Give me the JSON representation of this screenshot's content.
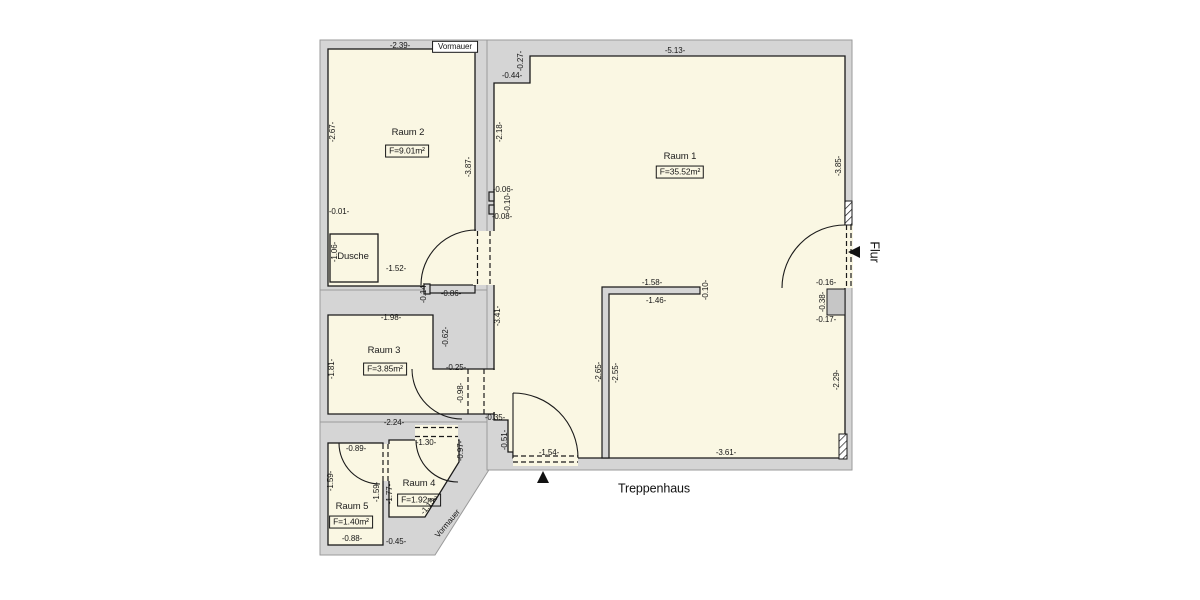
{
  "meta": {
    "drawing_type": "floor-plan",
    "language": "de"
  },
  "colors": {
    "room_fill": "#faf7e3",
    "wall_fill": "#d5d5d5",
    "outline": "#1a1a1a",
    "outer_edge": "#9a9a9a",
    "vormauer_block_fill": "#c6c6c6",
    "background": "#ffffff"
  },
  "plan": {
    "rooms_summary": [
      {
        "name": "Raum 1",
        "area": "F=35.52m²"
      },
      {
        "name": "Raum 2",
        "area": "F=9.01m²"
      },
      {
        "name": "Raum 3",
        "area": "F=3.85m²"
      },
      {
        "name": "Raum 4",
        "area": "F=1.92m²"
      },
      {
        "name": "Raum 5",
        "area": "F=1.40m²"
      },
      {
        "name": "Dusche",
        "area": ""
      }
    ],
    "zones": [
      "Treppenhaus",
      "Flur"
    ],
    "labels": [
      {
        "t": "-2.39-",
        "x": 400,
        "y": 46,
        "r": 0,
        "k": "d"
      },
      {
        "t": "Vormauer",
        "x": 455,
        "y": 47,
        "r": 0,
        "k": "db"
      },
      {
        "t": "-0.44-",
        "x": 512,
        "y": 76,
        "r": 0,
        "k": "d"
      },
      {
        "t": "-0.27-",
        "x": 521,
        "y": 61,
        "r": -90,
        "k": "d"
      },
      {
        "t": "-5.13-",
        "x": 675,
        "y": 51,
        "r": 0,
        "k": "d"
      },
      {
        "t": "-2.67-",
        "x": 333,
        "y": 132,
        "r": -90,
        "k": "d"
      },
      {
        "t": "Raum 2",
        "x": 408,
        "y": 133,
        "r": 0,
        "k": "room"
      },
      {
        "t": "F=9.01m²",
        "x": 407,
        "y": 151,
        "r": 0,
        "k": "area"
      },
      {
        "t": "-2.18-",
        "x": 500,
        "y": 132,
        "r": -90,
        "k": "d"
      },
      {
        "t": "-3.87-",
        "x": 469,
        "y": 167,
        "r": -90,
        "k": "d"
      },
      {
        "t": "Raum 1",
        "x": 680,
        "y": 157,
        "r": 0,
        "k": "room"
      },
      {
        "t": "F=35.52m²",
        "x": 680,
        "y": 172,
        "r": 0,
        "k": "area"
      },
      {
        "t": "-3.85-",
        "x": 839,
        "y": 166,
        "r": -90,
        "k": "d"
      },
      {
        "t": "-0.01-",
        "x": 339,
        "y": 212,
        "r": 0,
        "k": "d"
      },
      {
        "t": "-0.06-",
        "x": 503,
        "y": 190,
        "r": 0,
        "k": "d"
      },
      {
        "t": "-0.10-",
        "x": 508,
        "y": 203,
        "r": -90,
        "k": "d"
      },
      {
        "t": "-0.08-",
        "x": 502,
        "y": 217,
        "r": 0,
        "k": "d"
      },
      {
        "t": "-1.06-",
        "x": 335,
        "y": 252,
        "r": -90,
        "k": "d"
      },
      {
        "t": "Dusche",
        "x": 353,
        "y": 257,
        "r": 0,
        "k": "room"
      },
      {
        "t": "-1.52-",
        "x": 396,
        "y": 269,
        "r": 0,
        "k": "d"
      },
      {
        "t": "-0.86-",
        "x": 451,
        "y": 294,
        "r": 0,
        "k": "d"
      },
      {
        "t": "-0.14-",
        "x": 424,
        "y": 293,
        "r": -90,
        "k": "d"
      },
      {
        "t": "Flur",
        "x": 874,
        "y": 252,
        "r": 90,
        "k": "big"
      },
      {
        "t": "-0.16-",
        "x": 826,
        "y": 283,
        "r": 0,
        "k": "d"
      },
      {
        "t": "-0.38-",
        "x": 823,
        "y": 302,
        "r": -90,
        "k": "d"
      },
      {
        "t": "-0.17-",
        "x": 826,
        "y": 320,
        "r": 0,
        "k": "d"
      },
      {
        "t": "-1.58-",
        "x": 652,
        "y": 283,
        "r": 0,
        "k": "d"
      },
      {
        "t": "-1.46-",
        "x": 656,
        "y": 301,
        "r": 0,
        "k": "d"
      },
      {
        "t": "-0.10-",
        "x": 706,
        "y": 290,
        "r": -90,
        "k": "d"
      },
      {
        "t": "-3.41-",
        "x": 498,
        "y": 316,
        "r": -90,
        "k": "d"
      },
      {
        "t": "-1.98-",
        "x": 391,
        "y": 318,
        "r": 0,
        "k": "d"
      },
      {
        "t": "-0.62-",
        "x": 446,
        "y": 337,
        "r": -90,
        "k": "d"
      },
      {
        "t": "Raum 3",
        "x": 384,
        "y": 351,
        "r": 0,
        "k": "room"
      },
      {
        "t": "F=3.85m²",
        "x": 385,
        "y": 369,
        "r": 0,
        "k": "area"
      },
      {
        "t": "-1.81-",
        "x": 332,
        "y": 369,
        "r": -90,
        "k": "d"
      },
      {
        "t": "-0.25-",
        "x": 456,
        "y": 368,
        "r": 0,
        "k": "d"
      },
      {
        "t": "-0.98-",
        "x": 461,
        "y": 393,
        "r": -90,
        "k": "d"
      },
      {
        "t": "-2.65-",
        "x": 599,
        "y": 372,
        "r": -90,
        "k": "d"
      },
      {
        "t": "-2.55-",
        "x": 616,
        "y": 373,
        "r": -90,
        "k": "d"
      },
      {
        "t": "-2.29-",
        "x": 837,
        "y": 380,
        "r": -90,
        "k": "d"
      },
      {
        "t": "-0.35-",
        "x": 495,
        "y": 418,
        "r": 0,
        "k": "d"
      },
      {
        "t": "-2.24-",
        "x": 394,
        "y": 423,
        "r": 0,
        "k": "d"
      },
      {
        "t": "-0.51-",
        "x": 505,
        "y": 440,
        "r": -90,
        "k": "d"
      },
      {
        "t": "-1.30-",
        "x": 426,
        "y": 443,
        "r": 0,
        "k": "d"
      },
      {
        "t": "-0.89-",
        "x": 356,
        "y": 449,
        "r": 0,
        "k": "d"
      },
      {
        "t": "-0.97-",
        "x": 461,
        "y": 451,
        "r": -90,
        "k": "d"
      },
      {
        "t": "-1.54-",
        "x": 549,
        "y": 453,
        "r": 0,
        "k": "d"
      },
      {
        "t": "-3.61-",
        "x": 726,
        "y": 453,
        "r": 0,
        "k": "d"
      },
      {
        "t": "Raum 4",
        "x": 419,
        "y": 484,
        "r": 0,
        "k": "room"
      },
      {
        "t": "F=1.92m²",
        "x": 419,
        "y": 500,
        "r": 0,
        "k": "area"
      },
      {
        "t": "-1.59-",
        "x": 331,
        "y": 481,
        "r": -90,
        "k": "d"
      },
      {
        "t": "-1.59-",
        "x": 377,
        "y": 492,
        "r": -90,
        "k": "d"
      },
      {
        "t": "-1.77-",
        "x": 390,
        "y": 494,
        "r": -90,
        "k": "d"
      },
      {
        "t": "Treppenhaus",
        "x": 654,
        "y": 489,
        "r": 0,
        "k": "big"
      },
      {
        "t": "Raum 5",
        "x": 352,
        "y": 507,
        "r": 0,
        "k": "room"
      },
      {
        "t": "F=1.40m²",
        "x": 351,
        "y": 522,
        "r": 0,
        "k": "area"
      },
      {
        "t": "-1.13-",
        "x": 429,
        "y": 506,
        "r": -50,
        "k": "d"
      },
      {
        "t": "Vormauer",
        "x": 448,
        "y": 524,
        "r": -50,
        "k": "d"
      },
      {
        "t": "-0.88-",
        "x": 352,
        "y": 539,
        "r": 0,
        "k": "d"
      },
      {
        "t": "-0.45-",
        "x": 396,
        "y": 542,
        "r": 0,
        "k": "d"
      }
    ]
  }
}
